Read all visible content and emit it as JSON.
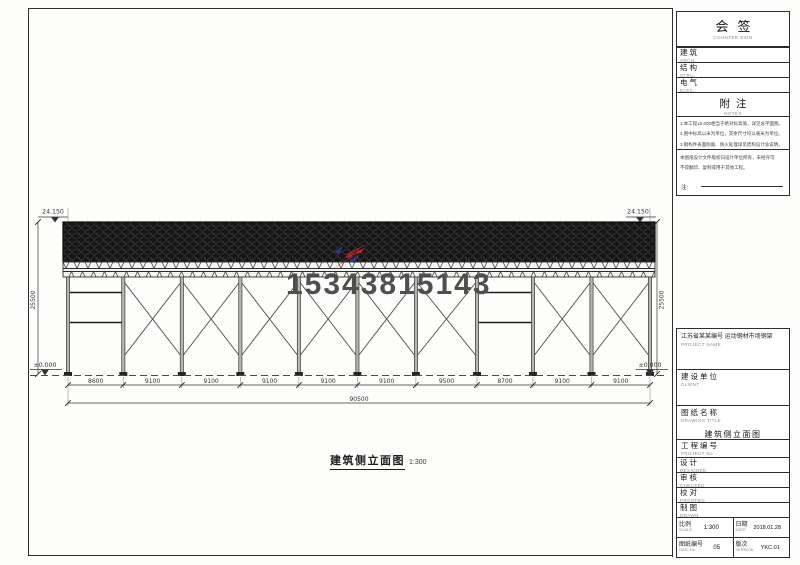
{
  "watermark": {
    "phone": "15343815143",
    "logo_red": "#c4242b",
    "logo_blue": "#203a8f"
  },
  "drawing": {
    "title": "建筑侧立面图",
    "scale_note": "1:300",
    "top_elevation_left": "24.150",
    "top_elevation_right": "24.150",
    "height_dim_left": "25500",
    "height_dim_right": "25500",
    "ground_elevation_left": "±0.000",
    "ground_elevation_right": "±0.000",
    "bay_dims": [
      "8600",
      "9100",
      "9100",
      "9100",
      "9100",
      "9100",
      "9500",
      "8700",
      "9100",
      "9100"
    ],
    "total_dim": "90500",
    "bays_bracing": [
      "beams",
      "x",
      "x",
      "x",
      "x",
      "x",
      "x",
      "beams",
      "x",
      "x"
    ]
  },
  "titleblock": {
    "sign": {
      "title": "会签",
      "sub": "COUNTER SIGN"
    },
    "disciplines": [
      {
        "label": "建筑",
        "sub": "ARCH."
      },
      {
        "label": "结构",
        "sub": "STRU."
      },
      {
        "label": "电气",
        "sub": "ELEC."
      }
    ],
    "notes": {
      "title": "附注",
      "sub": "NOTES",
      "lines1": [
        "1.本工程±0.000相当于绝对标高值，详见总平面图。",
        "2.图中标高以米为单位，其余尺寸均以毫米为单位。",
        "3.钢构件表面防腐、防火处理详见结构设计总说明。"
      ],
      "lines2": [
        "本图纸设计文件版权归设计单位所有，未经许可",
        "不得翻印、复制或用于其他工程。"
      ],
      "note_label": "注:"
    },
    "project": {
      "name": "江苏省某某编号 运动钢材市场钢架",
      "sub": "PROJECT NAME"
    },
    "client": {
      "label": "建设单位",
      "sub": "CLIENT"
    },
    "dwg_title": {
      "label": "图纸名称",
      "sub": "DRAWING TITLE",
      "value": "建筑侧立面图"
    },
    "proj_no": {
      "label": "工程编号",
      "sub": "PROJECT No."
    },
    "roles": [
      {
        "label": "设计",
        "sub": "DESIGNED"
      },
      {
        "label": "审核",
        "sub": "CHECKED"
      },
      {
        "label": "校对",
        "sub": "PROOFED"
      },
      {
        "label": "制图",
        "sub": "DRAWN"
      }
    ],
    "scale": {
      "label": "比例",
      "sub": "SCALE",
      "value": "1:300"
    },
    "date": {
      "label": "日期",
      "sub": "DATE",
      "value": "2018.01.28"
    },
    "dwg_no": {
      "label": "图纸编号",
      "sub": "DWG No.",
      "value": "05"
    },
    "version": {
      "label": "版次",
      "sub": "VERSION",
      "value": "YKC.01"
    }
  }
}
